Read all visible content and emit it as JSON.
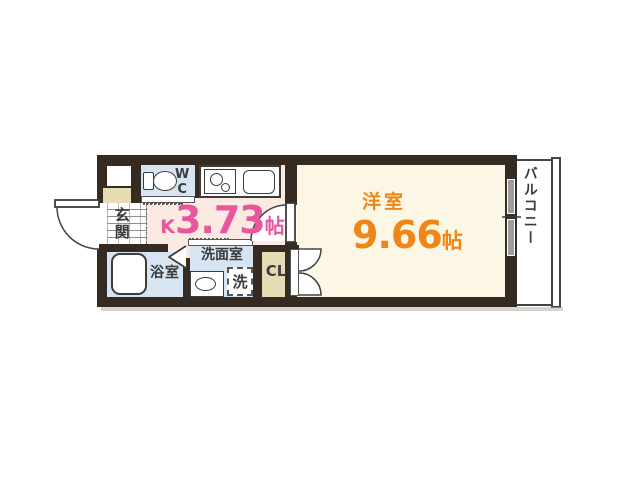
{
  "title": "1K apartment floor plan",
  "rooms": {
    "kitchen": {
      "prefix": "K",
      "area": "3.73",
      "unit": "帖"
    },
    "western_room": {
      "name": "洋室",
      "area": "9.66",
      "unit": "帖"
    },
    "entrance": {
      "name": "玄関"
    },
    "bathroom": {
      "name": "浴室"
    },
    "washroom": {
      "name": "洗面室"
    },
    "laundry_space": {
      "name": "洗"
    },
    "toilet_room": {
      "name": "WC"
    },
    "closet": {
      "name": "CL"
    },
    "balcony": {
      "name": "バルコニー"
    }
  },
  "icons": [
    "toilet-icon",
    "gas-stove-icon",
    "kitchen-sink-icon",
    "bathtub-icon",
    "vanity-sink-icon",
    "washing-machine-space-icon",
    "entrance-door-swing-icon",
    "room-door-swing-icon",
    "closet-double-door-icon",
    "bath-folding-door-icon",
    "sliding-window-icon",
    "balcony-railing-icon"
  ],
  "colors": {
    "wall": "#362b23",
    "kitchen_floor": "#fbeae1",
    "room_floor": "#fbf7e4",
    "wet_floor": "#d7e5f2",
    "storage_floor": "#e5dcb6",
    "kitchen_label": "#e9569b",
    "room_label": "#ee8718",
    "text": "#3a3a3a",
    "window_glass": "#9d9d9d",
    "outline": "#3c3c3c"
  }
}
